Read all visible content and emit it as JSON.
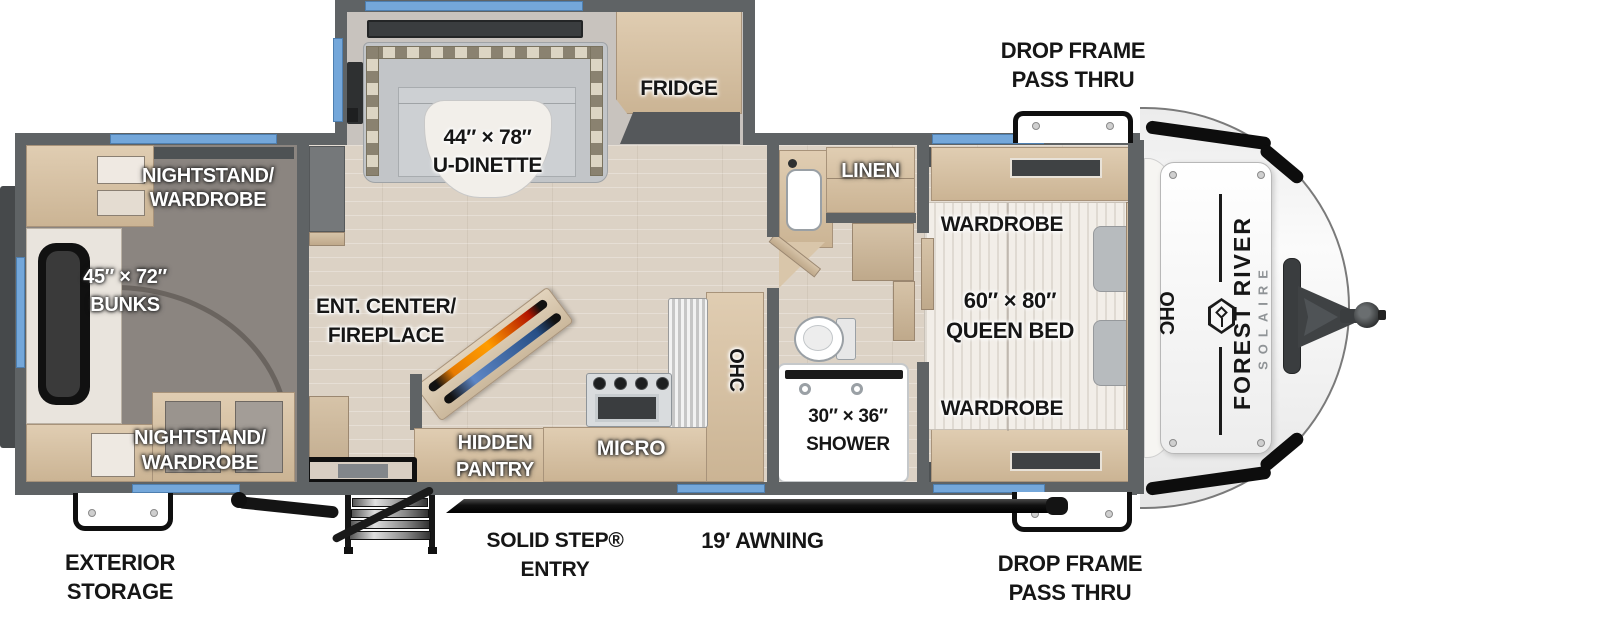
{
  "title": "Forest River Solaire travel trailer floor plan",
  "brand": {
    "name": "FOREST RIVER",
    "series": "SOLAIRE"
  },
  "exterior": {
    "drop_frame_top": "DROP FRAME\nPASS THRU",
    "drop_frame_bottom": "DROP FRAME\nPASS THRU",
    "exterior_storage": "EXTERIOR\nSTORAGE",
    "solid_step_entry": "SOLID STEP®\nENTRY",
    "awning": "19′ AWNING"
  },
  "bunk_room": {
    "nightstand_top": "NIGHTSTAND/\nWARDROBE",
    "bunks": "45″ × 72″\nBUNKS",
    "nightstand_bottom": "NIGHTSTAND/\nWARDROBE"
  },
  "living": {
    "dinette": "44″ × 78″\nU-DINETTE",
    "fridge": "FRIDGE",
    "ent_center": "ENT. CENTER/\nFIREPLACE"
  },
  "kitchen": {
    "pantry": "HIDDEN\nPANTRY",
    "micro": "MICRO",
    "ohc": "OHC"
  },
  "bathroom": {
    "linen": "LINEN",
    "shower": "30″ × 36″\nSHOWER"
  },
  "bedroom": {
    "wardrobe_top": "WARDROBE",
    "queen_bed": "60″ × 80″\nQUEEN BED",
    "wardrobe_bottom": "WARDROBE",
    "ohc": "OHC"
  },
  "colors": {
    "window_blue": "#74A7DA",
    "wall_gray": "#5F6365",
    "wood": "#D7C2A8",
    "floor": "#DCD2C5",
    "carpet": "#8B8580",
    "awning_black": "#151515"
  }
}
